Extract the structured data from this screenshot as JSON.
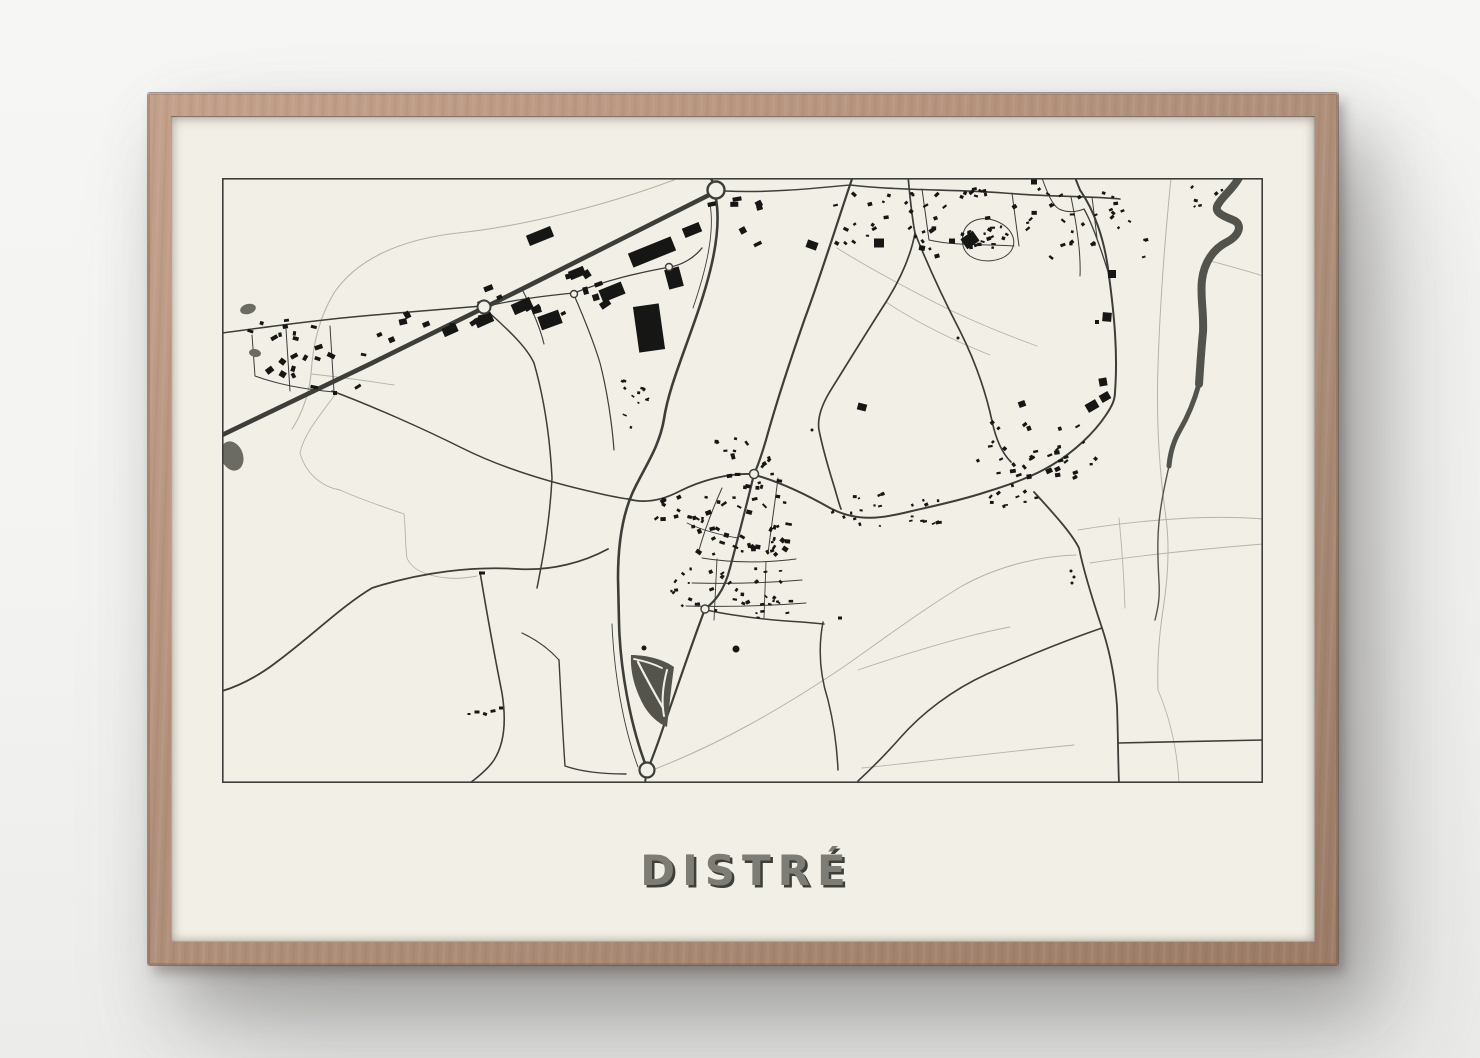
{
  "poster": {
    "title": "DISTRÉ"
  },
  "colors": {
    "wall": "#f3f3f1",
    "frame_wood": "#b5937d",
    "paper": "#f2f0e6",
    "ink": "#3d3d39",
    "ink_light": "#b4b4aa",
    "building": "#161614",
    "water": "#53534d",
    "pond": "#6b6b63",
    "interchange": "#54544d",
    "title_fill": "#7d7d75",
    "title_shadow": "#3f3f3a"
  },
  "map": {
    "width": 1041,
    "height": 605,
    "border_width": 1.6,
    "light_roads": [
      {
        "d": "M 452 2 C 382 28 302 48 236 55 C 172 62 132 85 112 115 C 97 140 91 166 89 196 C 87 216 80 236 70 251",
        "w": 1.1
      },
      {
        "d": "M 89 196 C 118 199 146 203 172 207",
        "w": 0.9
      },
      {
        "d": "M 433 591 C 500 565 560 530 620 490 C 660 462 700 432 740 408 C 780 386 822 378 854 377",
        "w": 1
      },
      {
        "d": "M 636 492 C 680 477 740 458 788 449",
        "w": 0.9
      },
      {
        "d": "M 868 385 C 920 377 980 371 1041 366",
        "w": 0.9
      },
      {
        "d": "M 897 340 C 900 370 902 400 903 430",
        "w": 0.9
      },
      {
        "d": "M 856 352 C 892 346 930 342 968 340 C 993 339 1017 339 1041 341",
        "w": 0.9
      },
      {
        "d": "M 949 0 C 943 60 938 125 936 188 C 934 245 938 298 944 340 C 948 370 946 400 941 432 C 937 458 935 485 936 512",
        "w": 1
      },
      {
        "d": "M 985 82 C 1003 87 1022 92 1041 98",
        "w": 0.9
      },
      {
        "d": "M 936 512 C 948 540 955 570 957 605",
        "w": 0.9
      },
      {
        "d": "M 615 70 C 650 92 690 113 730 133 C 762 148 790 159 815 168",
        "w": 0.9
      },
      {
        "d": "M 664 124 C 697 146 733 163 768 177",
        "w": 0.9
      },
      {
        "d": "M 640 590 C 700 584 770 575 852 567",
        "w": 0.9
      },
      {
        "d": "M 115 214 C 100 235 82 255 78 275 C 85 300 105 310 118 312 C 140 322 165 330 182 336 C 184 355 183 368 185 380 C 190 392 205 398 225 400 C 235 401 245 400 255 398",
        "w": 0.9
      }
    ],
    "dark_roads": [
      {
        "d": "M -4 259 L 148 186 L 300 111 L 489 16",
        "w": 4.6
      },
      {
        "d": "M 491 4 L 486 -4",
        "w": 2.4
      },
      {
        "d": "M 494 21 C 500 55 488 100 472 145 C 458 185 446 214 442 241 C 437 271 421 291 410 316 C 400 339 396 368 396 400 L 397 444 C 398 490 408 546 424 588",
        "w": 2.6
      },
      {
        "d": "M 488 26 C 493 55 484 92 471 130",
        "w": 0.9
      },
      {
        "d": "M 390 446 C 392 495 401 548 416 589",
        "w": 0.9
      },
      {
        "d": "M 631 -2 C 615 45 598 100 583 140 C 568 183 555 222 544 262 C 538 282 534 292 532 296 C 524 330 516 360 508 390 C 502 414 492 424 483 431 C 470 465 455 510 440 553 C 433 574 428 585 426 592",
        "w": 2.2
      },
      {
        "d": "M 530 296 C 505 295 478 303 458 313 C 441 322 424 326 406 321",
        "w": 1.8
      },
      {
        "d": "M 533 297 C 558 304 585 317 608 330 C 636 345 662 340 690 333 C 712 328 740 322 764 314 C 790 306 812 298 830 287 C 852 274 872 255 884 237 C 890 228 893 222 893 214 C 896 175 892 135 887 98 C 883 62 872 32 858 12 L 854 2",
        "w": 2
      },
      {
        "d": "M 686 -2 C 688 20 690 40 693 55 C 688 82 676 105 664 124 C 646 152 625 186 607 215 C 600 227 595 240 597 252 C 601 272 607 292 612 308 C 615 318 617 326 619 331",
        "w": 1.7
      },
      {
        "d": "M 693 55 C 706 88 722 122 738 153 C 753 183 764 215 770 243 C 774 262 781 276 789 284",
        "w": 1.7
      },
      {
        "d": "M 812 314 C 834 338 850 356 857 370 C 862 395 872 426 880 450 C 888 474 893 500 895 528 C 896 555 896 580 897 606",
        "w": 1.8
      },
      {
        "d": "M 880 450 C 845 462 805 478 765 496 C 730 512 700 535 678 560 C 664 576 650 590 636 603",
        "w": 1.6
      },
      {
        "d": "M 896 565 C 940 564 990 563 1041 562",
        "w": 1.6
      },
      {
        "d": "M 601 444 C 596 470 598 497 606 522 C 612 546 615 570 616 592",
        "w": 1.5
      },
      {
        "d": "M 484 432 C 512 438 546 442 580 444 L 602 446",
        "w": 1.5
      },
      {
        "d": "M -3 514 C 18 508 38 497 56 483 C 92 456 120 428 150 410 C 200 394 252 388 296 391 C 330 393 362 384 386 371",
        "w": 1.8
      },
      {
        "d": "M 258 394 C 264 430 272 475 280 515 C 284 540 283 565 272 582 C 266 591 256 599 248 605",
        "w": 1.6
      },
      {
        "d": "M 0 155 C 52 148 104 141 152 137 C 190 134 226 131 260 128",
        "w": 1.5
      },
      {
        "d": "M 64 151 L 68 213",
        "w": 1
      },
      {
        "d": "M 108 148 L 112 214",
        "w": 1
      },
      {
        "d": "M 30 157 L 33 198",
        "w": 1
      },
      {
        "d": "M 33 198 C 60 208 90 212 112 214",
        "w": 1
      },
      {
        "d": "M 262 130 C 290 155 305 170 312 185 C 322 220 328 260 330 300 C 328 340 322 375 315 410",
        "w": 1.5
      },
      {
        "d": "M 110 213 C 150 228 200 250 240 270 C 280 290 330 305 375 315 C 388 318 398 320 406 321",
        "w": 1.5
      },
      {
        "d": "M 352 117 C 362 140 372 165 378 185 C 385 212 390 245 392 272",
        "w": 1.2
      },
      {
        "d": "M 262 129 C 290 122 320 118 352 115 C 385 102 415 95 448 89 C 460 87 472 80 480 70",
        "w": 1.3
      },
      {
        "d": "M 503 13 C 545 15 586 11 628 7",
        "w": 1.5
      },
      {
        "d": "M 628 7 C 680 13 732 11 782 15 C 830 19 866 18 898 21",
        "w": 1.6
      },
      {
        "d": "M 700 11 L 707 62",
        "w": 1
      },
      {
        "d": "M 707 62 C 733 68 762 66 792 68",
        "w": 1
      },
      {
        "d": "M 790 15 L 797 68",
        "w": 1
      },
      {
        "d": "M 849 19 C 855 48 859 76 858 98",
        "w": 1
      },
      {
        "d": "M 741 56 C 744 43 759 37 774 43 C 789 49 796 62 789 73 C 781 84 760 86 748 78 C 741 73 739 64 741 56 Z",
        "w": 1
      },
      {
        "d": "M 870 19 L 875 60",
        "w": 1
      },
      {
        "d": "M 820 0 C 825 14 830 27 837 31 C 845 35 855 34 862 31",
        "w": 1
      },
      {
        "d": "M 862 31 C 870 45 880 74 888 100",
        "w": 1.3
      },
      {
        "d": "M 424 596 L 423 606",
        "w": 2
      },
      {
        "d": "M 337 482 C 339 520 341 560 343 588 C 360 594 380 596 404 596",
        "w": 1.4
      },
      {
        "d": "M 300 455 C 315 462 328 472 337 482",
        "w": 1.2
      },
      {
        "d": "M 300 111 C 310 131 318 149 322 166",
        "w": 1.1
      },
      {
        "d": "M 480 380 C 510 385 544 385 574 381",
        "w": 1
      },
      {
        "d": "M 470 405 C 505 406 545 405 580 402",
        "w": 1
      },
      {
        "d": "M 464 428 C 500 429 545 428 584 425",
        "w": 1
      },
      {
        "d": "M 495 381 L 492 442",
        "w": 0.9
      },
      {
        "d": "M 544 384 L 542 440",
        "w": 0.9
      },
      {
        "d": "M 500 310 C 491 330 483 351 477 372",
        "w": 1
      },
      {
        "d": "M 556 300 C 553 325 549 350 546 376",
        "w": 1
      },
      {
        "d": "M 465 345 C 480 352 498 357 516 360",
        "w": 0.9
      }
    ],
    "river": [
      {
        "d": "M 1018 -2 C 1012 10 1002 17 997 25 C 990 34 1001 38 1011 42 C 1021 46 1018 57 1005 64 C 991 71 982 85 980 102 C 978 118 982 134 981 154 C 979 174 978 192 977 206",
        "w": 8
      },
      {
        "d": "M 977 206 C 972 224 965 240 958 252 C 951 264 948 276 947 288",
        "w": 5
      },
      {
        "d": "M 947 288 C 943 306 939 324 937 344 C 935 365 936 385 937 404 C 938 420 936 430 933 442",
        "w": 1.4
      }
    ],
    "interchange": {
      "outline": "M 409 477 C 428 477 444 483 452 489 C 449 510 447 532 445 549 C 436 545 428 538 422 528 C 413 512 408 494 409 477 Z",
      "slips": [
        {
          "d": "M 416 484 C 424 500 433 516 441 530",
          "w": 2.2
        },
        {
          "d": "M 445 492 C 441 507 439 522 442 538",
          "w": 2
        },
        {
          "d": "M 412 481 C 422 483 432 486 440 490",
          "w": 1.8
        }
      ]
    },
    "ponds": [
      {
        "cx": 26,
        "cy": 131,
        "rx": 8,
        "ry": 5,
        "rot": -15
      },
      {
        "cx": 33,
        "cy": 175,
        "rx": 6,
        "ry": 4,
        "rot": 10
      },
      {
        "cx": 10,
        "cy": 278,
        "rx": 11,
        "ry": 15,
        "rot": -20
      }
    ],
    "dots": [
      {
        "x": 514,
        "y": 471,
        "r": 3.5
      },
      {
        "x": 422,
        "y": 470,
        "r": 2.5
      },
      {
        "x": 849,
        "y": 393,
        "r": 1.5
      },
      {
        "x": 852,
        "y": 399,
        "r": 1.5
      },
      {
        "x": 850,
        "y": 405,
        "r": 1.5
      },
      {
        "x": 736,
        "y": 160,
        "r": 1.5
      },
      {
        "x": 590,
        "y": 252,
        "r": 1.5
      }
    ],
    "bigs": [
      {
        "x": 430,
        "y": 74,
        "w": 46,
        "h": 15,
        "rot": -22
      },
      {
        "x": 427,
        "y": 150,
        "w": 26,
        "h": 46,
        "rot": -8
      },
      {
        "x": 390,
        "y": 114,
        "w": 24,
        "h": 13,
        "rot": -22
      },
      {
        "x": 318,
        "y": 58,
        "w": 26,
        "h": 11,
        "rot": -22
      },
      {
        "x": 328,
        "y": 142,
        "w": 22,
        "h": 14,
        "rot": -20
      },
      {
        "x": 300,
        "y": 128,
        "w": 20,
        "h": 11,
        "rot": -24
      },
      {
        "x": 262,
        "y": 142,
        "w": 18,
        "h": 10,
        "rot": -24
      },
      {
        "x": 228,
        "y": 152,
        "w": 15,
        "h": 9,
        "rot": -24
      },
      {
        "x": 452,
        "y": 100,
        "w": 15,
        "h": 20,
        "rot": -15
      },
      {
        "x": 470,
        "y": 52,
        "w": 18,
        "h": 10,
        "rot": -22
      },
      {
        "x": 355,
        "y": 95,
        "w": 16,
        "h": 9,
        "rot": -22
      },
      {
        "x": 590,
        "y": 67,
        "w": 11,
        "h": 8,
        "rot": 20
      },
      {
        "x": 657,
        "y": 65,
        "w": 10,
        "h": 9,
        "rot": 0
      },
      {
        "x": 748,
        "y": 62,
        "w": 15,
        "h": 12,
        "rot": -35
      },
      {
        "x": 870,
        "y": 228,
        "w": 12,
        "h": 9,
        "rot": -30
      },
      {
        "x": 883,
        "y": 219,
        "w": 10,
        "h": 8,
        "rot": -30
      }
    ],
    "singles": [
      {
        "x": 890,
        "y": 96,
        "w": 8,
        "h": 8,
        "rot": 0
      },
      {
        "x": 885,
        "y": 139,
        "w": 9,
        "h": 9,
        "rot": 5
      },
      {
        "x": 875,
        "y": 144,
        "w": 4,
        "h": 4,
        "rot": 0
      },
      {
        "x": 881,
        "y": 204,
        "w": 8,
        "h": 8,
        "rot": -10
      },
      {
        "x": 640,
        "y": 229,
        "w": 9,
        "h": 7,
        "rot": 15
      },
      {
        "x": 800,
        "y": 226,
        "w": 7,
        "h": 6,
        "rot": -20
      },
      {
        "x": 255,
        "y": 534,
        "w": 5,
        "h": 3,
        "rot": 0
      },
      {
        "x": 263,
        "y": 536,
        "w": 4,
        "h": 3,
        "rot": 20
      },
      {
        "x": 271,
        "y": 533,
        "w": 5,
        "h": 3,
        "rot": -10
      },
      {
        "x": 279,
        "y": 530,
        "w": 4,
        "h": 3,
        "rot": 0
      },
      {
        "x": 247,
        "y": 536,
        "w": 3,
        "h": 2,
        "rot": 0
      },
      {
        "x": 260,
        "y": 395,
        "w": 6,
        "h": 3,
        "rot": 0
      },
      {
        "x": 700,
        "y": 70,
        "w": 6,
        "h": 5,
        "rot": 10
      },
      {
        "x": 715,
        "y": 78,
        "w": 5,
        "h": 4,
        "rot": -15
      },
      {
        "x": 730,
        "y": 63,
        "w": 6,
        "h": 5,
        "rot": 0
      },
      {
        "x": 812,
        "y": 4,
        "w": 6,
        "h": 5,
        "rot": 0
      },
      {
        "x": 618,
        "y": 440,
        "w": 4,
        "h": 3,
        "rot": 0
      },
      {
        "x": 113,
        "y": 215,
        "w": 4,
        "h": 4,
        "rot": 0
      }
    ],
    "clusters": [
      {
        "cx": 92,
        "cy": 180,
        "rx": 52,
        "ry": 30,
        "n": 15,
        "smin": 3.5,
        "smax": 8,
        "rot": 0,
        "jr": 40
      },
      {
        "cx": 60,
        "cy": 150,
        "rx": 42,
        "ry": 8,
        "n": 7,
        "smin": 3,
        "smax": 6,
        "rot": 0,
        "jr": 20
      },
      {
        "cx": 205,
        "cy": 150,
        "rx": 48,
        "ry": 16,
        "n": 9,
        "smin": 4,
        "smax": 9,
        "rot": -24,
        "jr": 12
      },
      {
        "cx": 298,
        "cy": 126,
        "rx": 45,
        "ry": 16,
        "n": 8,
        "smin": 4,
        "smax": 10,
        "rot": -24,
        "jr": 12
      },
      {
        "cx": 372,
        "cy": 112,
        "rx": 30,
        "ry": 16,
        "n": 6,
        "smin": 5,
        "smax": 11,
        "rot": -24,
        "jr": 10
      },
      {
        "cx": 512,
        "cy": 42,
        "rx": 26,
        "ry": 24,
        "n": 7,
        "smin": 4,
        "smax": 9,
        "rot": -20,
        "jr": 20
      },
      {
        "cx": 405,
        "cy": 225,
        "rx": 22,
        "ry": 28,
        "n": 12,
        "smin": 2,
        "smax": 4.5,
        "rot": 15,
        "jr": 40
      },
      {
        "cx": 655,
        "cy": 38,
        "rx": 42,
        "ry": 28,
        "n": 20,
        "smin": 2.5,
        "smax": 5.5,
        "rot": 0,
        "jr": 45
      },
      {
        "cx": 752,
        "cy": 42,
        "rx": 52,
        "ry": 32,
        "n": 28,
        "smin": 2.5,
        "smax": 5.5,
        "rot": 0,
        "jr": 45
      },
      {
        "cx": 850,
        "cy": 45,
        "rx": 45,
        "ry": 36,
        "n": 24,
        "smin": 2.5,
        "smax": 5.5,
        "rot": 0,
        "jr": 45
      },
      {
        "cx": 910,
        "cy": 55,
        "rx": 22,
        "ry": 30,
        "n": 9,
        "smin": 2.5,
        "smax": 5,
        "rot": 0,
        "jr": 45
      },
      {
        "cx": 766,
        "cy": 60,
        "rx": 20,
        "ry": 12,
        "n": 9,
        "smin": 2.5,
        "smax": 4.5,
        "rot": -40,
        "jr": 60
      },
      {
        "cx": 975,
        "cy": 18,
        "rx": 30,
        "ry": 14,
        "n": 6,
        "smin": 2,
        "smax": 4.5,
        "rot": 0,
        "jr": 45
      },
      {
        "cx": 520,
        "cy": 348,
        "rx": 48,
        "ry": 30,
        "n": 42,
        "smin": 2.5,
        "smax": 6.5,
        "rot": 0,
        "jr": 45
      },
      {
        "cx": 505,
        "cy": 408,
        "rx": 56,
        "ry": 20,
        "n": 28,
        "smin": 2,
        "smax": 5,
        "rot": 0,
        "jr": 45
      },
      {
        "cx": 530,
        "cy": 430,
        "rx": 40,
        "ry": 10,
        "n": 12,
        "smin": 2,
        "smax": 4.5,
        "rot": 0,
        "jr": 30
      },
      {
        "cx": 455,
        "cy": 335,
        "rx": 24,
        "ry": 16,
        "n": 11,
        "smin": 2.5,
        "smax": 5.5,
        "rot": 0,
        "jr": 45
      },
      {
        "cx": 532,
        "cy": 292,
        "rx": 28,
        "ry": 20,
        "n": 13,
        "smin": 2.5,
        "smax": 5.5,
        "rot": 0,
        "jr": 45
      },
      {
        "cx": 508,
        "cy": 268,
        "rx": 18,
        "ry": 14,
        "n": 8,
        "smin": 2.5,
        "smax": 5,
        "rot": 10,
        "jr": 45
      },
      {
        "cx": 660,
        "cy": 340,
        "rx": 58,
        "ry": 8,
        "n": 15,
        "smin": 2,
        "smax": 4.5,
        "rot": -5,
        "jr": 25
      },
      {
        "cx": 680,
        "cy": 322,
        "rx": 52,
        "ry": 7,
        "n": 10,
        "smin": 2,
        "smax": 4.5,
        "rot": -10,
        "jr": 25
      },
      {
        "cx": 815,
        "cy": 272,
        "rx": 60,
        "ry": 28,
        "n": 36,
        "smin": 2.5,
        "smax": 6.5,
        "rot": -28,
        "jr": 25
      },
      {
        "cx": 790,
        "cy": 318,
        "rx": 25,
        "ry": 12,
        "n": 10,
        "smin": 2,
        "smax": 4.5,
        "rot": -20,
        "jr": 30
      }
    ],
    "roundabouts": [
      {
        "x": 494,
        "y": 12,
        "r": 8.5,
        "w": 2.4
      },
      {
        "x": 262,
        "y": 129,
        "r": 6.5,
        "w": 2
      },
      {
        "x": 352,
        "y": 116,
        "r": 3.5,
        "w": 1.4
      },
      {
        "x": 447,
        "y": 89,
        "r": 3.5,
        "w": 1.4
      },
      {
        "x": 532,
        "y": 296,
        "r": 4.5,
        "w": 1.5
      },
      {
        "x": 483,
        "y": 431,
        "r": 4,
        "w": 1.4
      },
      {
        "x": 425,
        "y": 592,
        "r": 7.5,
        "w": 2.2
      }
    ]
  }
}
